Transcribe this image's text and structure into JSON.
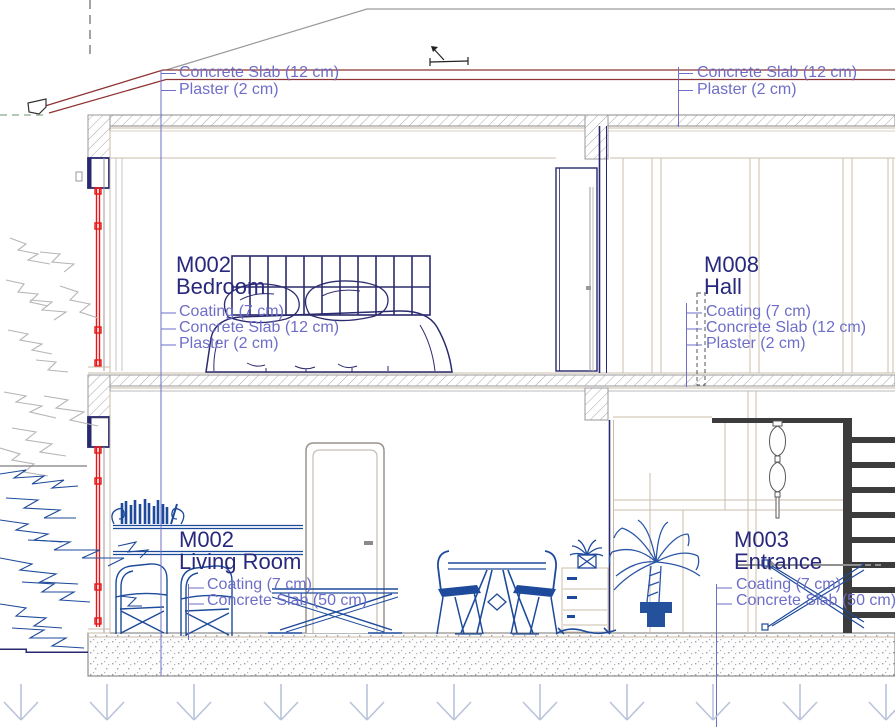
{
  "roof_callouts": {
    "left": {
      "lines": [
        "Concrete Slab (12 cm)",
        "Plaster (2 cm)"
      ]
    },
    "right": {
      "lines": [
        "Concrete Slab (12 cm)",
        "Plaster (2 cm)"
      ]
    }
  },
  "rooms": {
    "bedroom": {
      "code": "M002",
      "name": "Bedroom",
      "layers": [
        "Coating (7 cm)",
        "Concrete Slab (12 cm)",
        "Plaster (2 cm)"
      ]
    },
    "hall": {
      "code": "M008",
      "name": "Hall",
      "layers": [
        "Coating (7 cm)",
        "Concrete Slab (12 cm)",
        "Plaster (2 cm)"
      ]
    },
    "living_room": {
      "code": "M002",
      "name": "Living Room",
      "layers": [
        "Coating (7 cm)",
        "Concrete Slab (50 cm)"
      ]
    },
    "entrance": {
      "code": "M003",
      "name": "Entrance",
      "layers": [
        "Coating (7 cm)",
        "Concrete Slab (50 cm)"
      ]
    }
  },
  "colors": {
    "callout_text": "#6e6ec8",
    "room_title": "#28287c",
    "roof_line": "#8f3434",
    "window_section_red": "#e81616",
    "wall_finish_tan": "#cbbca9",
    "structure_navy": "#28286e",
    "furniture_blue": "#1d4a9a",
    "bed_indigo": "#2b2b6e",
    "palm_blue": "#2b56a8",
    "stair_dark": "#3c3c3c",
    "ground_arrow": "#b9c3da"
  }
}
